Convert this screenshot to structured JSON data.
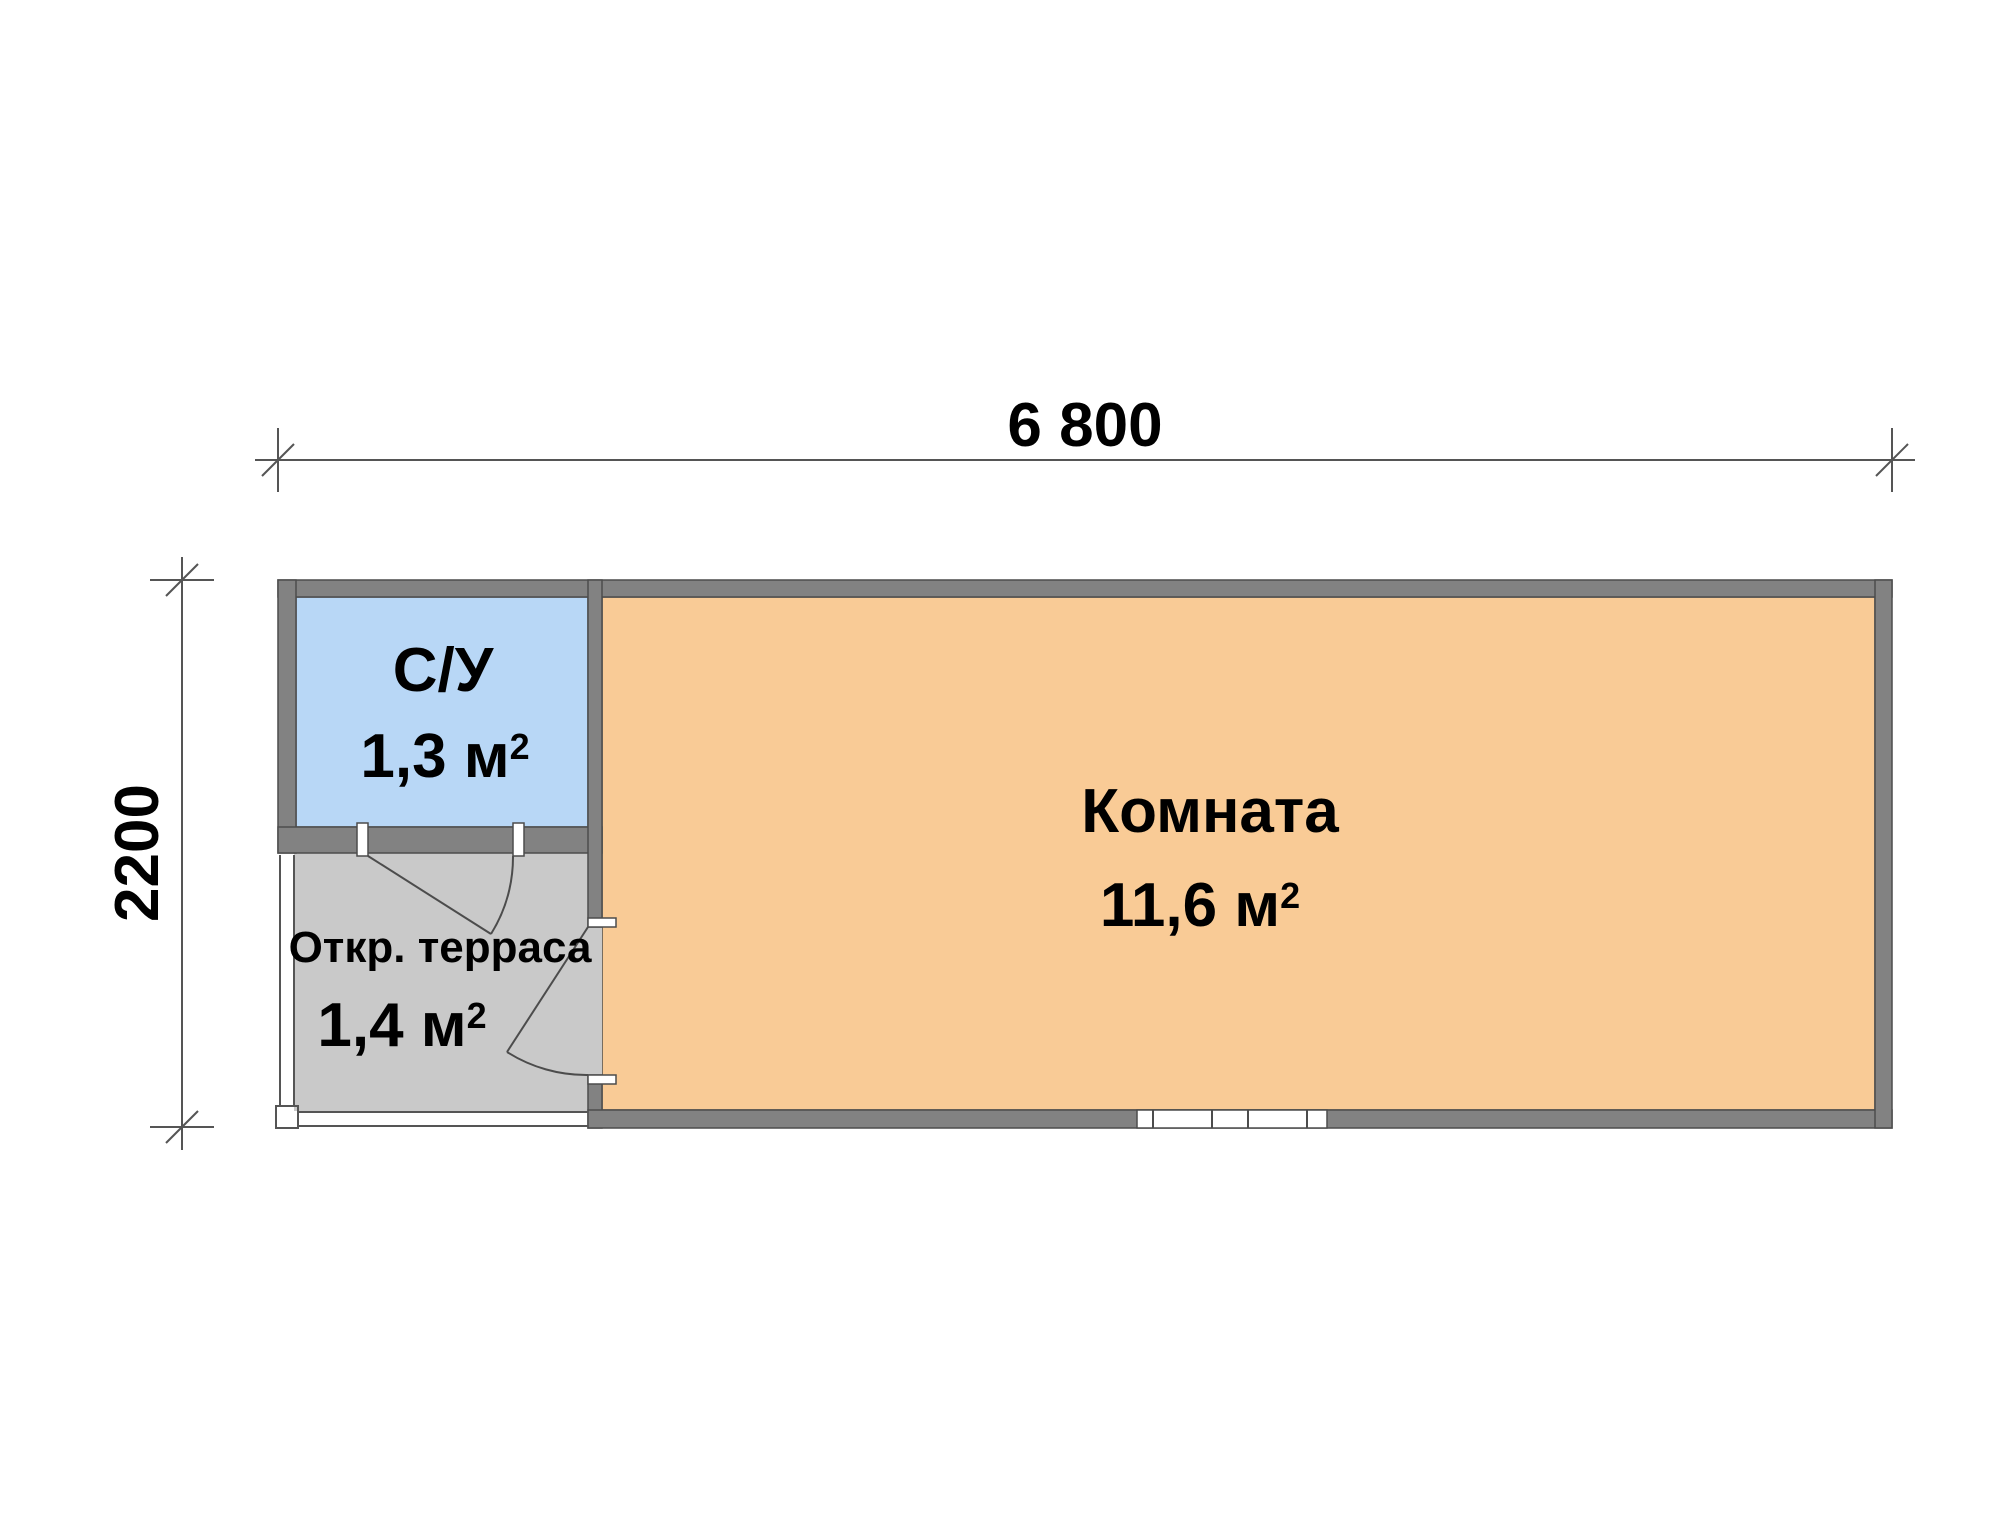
{
  "colors": {
    "room": "#F9CB96",
    "bathroom": "#B8D7F6",
    "terrace": "#C9C9C9",
    "wall": "#828282",
    "outline": "#4C4C4C",
    "dim_line": "#555555",
    "background": "#FFFFFF",
    "text": "#000000"
  },
  "dimensions": {
    "width": "6 800",
    "height": "2200"
  },
  "rooms": {
    "bathroom": {
      "name": "С/У",
      "area": "1,3 м",
      "area_sup": "2"
    },
    "terrace": {
      "name": "Откр. терраса",
      "area": "1,4 м",
      "area_sup": "2"
    },
    "room": {
      "name": "Комната",
      "area": "11,6 м",
      "area_sup": "2"
    }
  }
}
